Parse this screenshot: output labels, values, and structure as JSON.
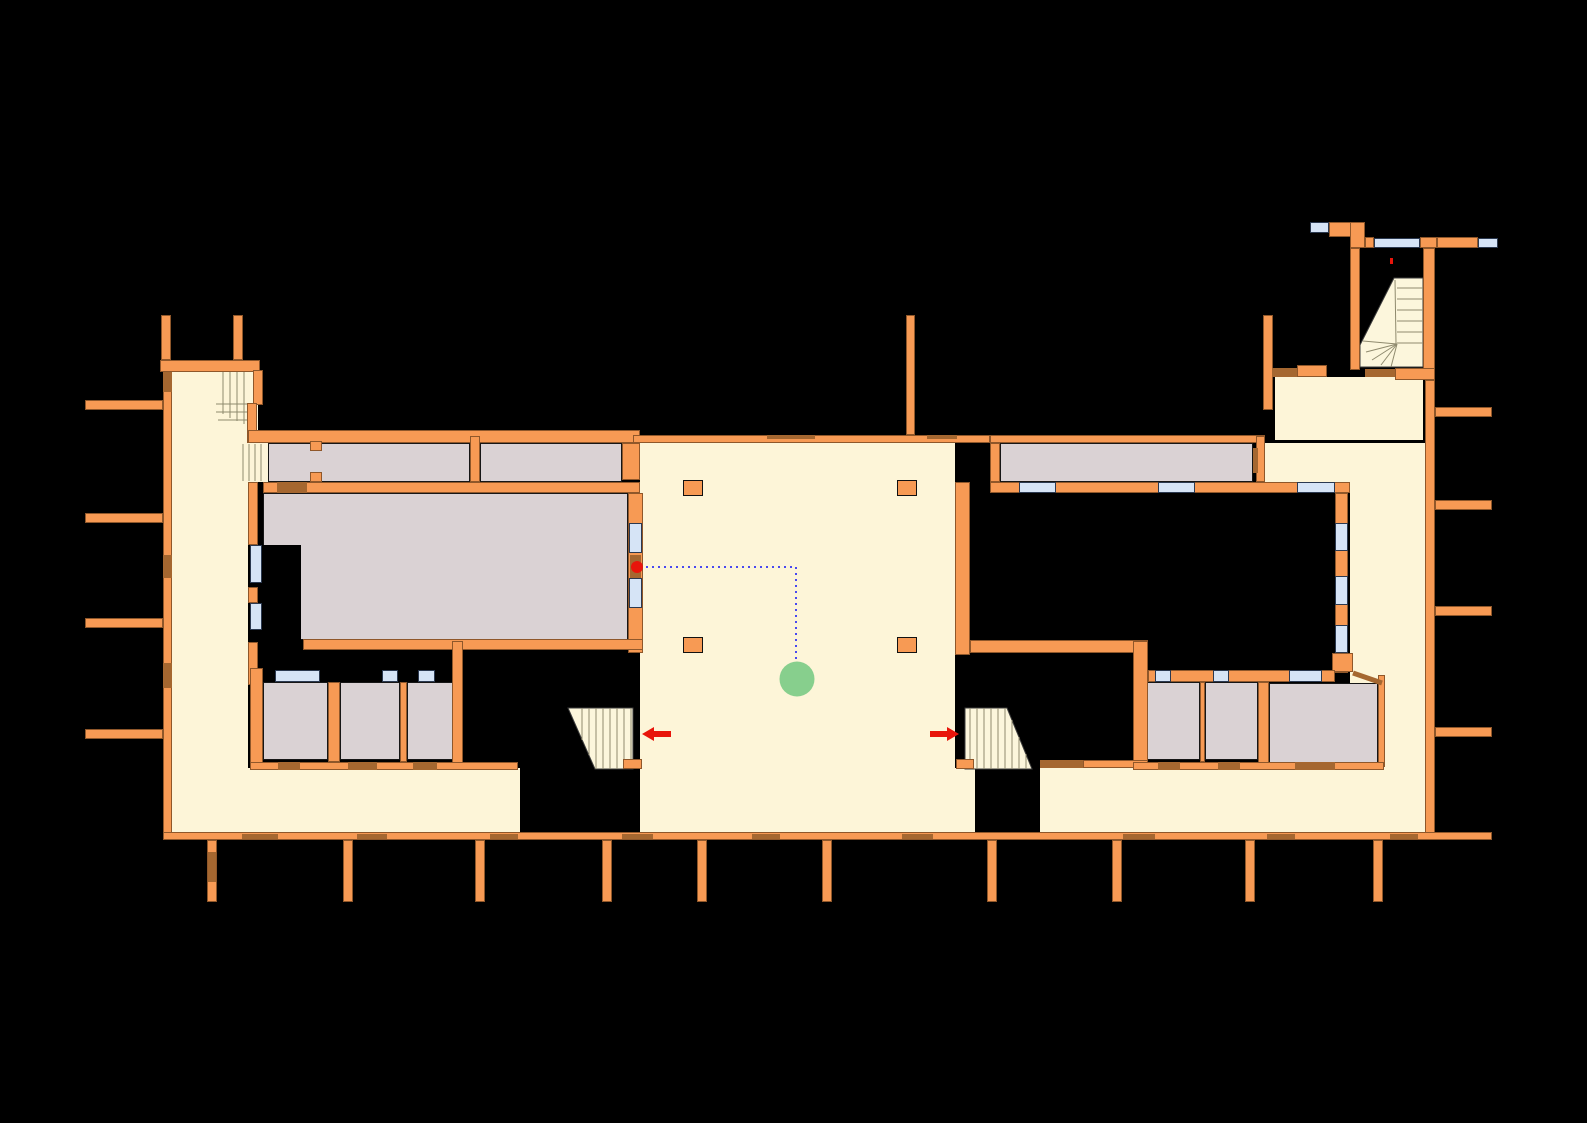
{
  "title": "floor-plan",
  "labels": {
    "hall": "Зала 6",
    "exit_left": "за ет. III",
    "exit_right": "за ет. III"
  },
  "palette": {
    "bg": "#000000",
    "wall": "#F79A54",
    "door": "#A56730",
    "floor": "#FDF5D8",
    "room": "#DAD2D4",
    "window": "#D6E4F6",
    "stair": "#FCF6DC",
    "stair_line": "#8F8A6E",
    "route": "#4949F0",
    "red": "#E8150B",
    "green": "#87CF8D",
    "text": "#111111",
    "wall_border": "rgba(40,20,0,0.5)",
    "window_border": "#2B3950",
    "room_border": "#161616",
    "poly_border": "#3C3C3C"
  },
  "marker": {
    "cx": 797,
    "cy": 679,
    "r": 17.5
  },
  "red_dot": {
    "cx": 637,
    "cy": 567,
    "r": 6
  },
  "red_mark": [
    1390,
    258,
    3,
    6
  ],
  "route_points": "646,567 796,567 796,660",
  "corner_diag": [
    1353,
    673,
    1382,
    683
  ],
  "arrow_left_points": "642,734 654,727 654,731 671,731 671,737 654,737 654,741",
  "arrow_right_points": "959,734 947,727 947,731 930,731 930,737 947,737 947,741",
  "label_pos": {
    "hall": [
      490,
      548
    ],
    "exit_left": [
      672,
      726
    ],
    "exit_right": [
      862,
      726
    ]
  },
  "plan": {
    "floors": [
      [
        170,
        368,
        78,
        465
      ],
      [
        215,
        367,
        43,
        63
      ],
      [
        248,
        442,
        20,
        40
      ],
      [
        640,
        443,
        315,
        325
      ],
      [
        170,
        768,
        350,
        65
      ],
      [
        640,
        768,
        335,
        65
      ],
      [
        1040,
        768,
        385,
        65
      ],
      [
        1275,
        377,
        148,
        63
      ],
      [
        1265,
        443,
        160,
        39
      ],
      [
        1350,
        482,
        75,
        351
      ]
    ],
    "rooms": [
      [
        268,
        443,
        202,
        39
      ],
      [
        480,
        443,
        142,
        39
      ],
      [
        263,
        493,
        365,
        147
      ],
      [
        263,
        682,
        65,
        78
      ],
      [
        340,
        682,
        60,
        78
      ],
      [
        407,
        682,
        46,
        78
      ],
      [
        1000,
        443,
        253,
        39
      ],
      [
        1144,
        682,
        56,
        78
      ],
      [
        1205,
        682,
        53,
        78
      ],
      [
        1269,
        683,
        109,
        81
      ]
    ],
    "voids": [
      [
        263,
        545,
        38,
        95
      ],
      [
        265,
        650,
        187,
        20
      ],
      [
        463,
        650,
        177,
        118
      ],
      [
        520,
        768,
        120,
        64
      ],
      [
        955,
        653,
        178,
        115
      ],
      [
        975,
        768,
        65,
        64
      ]
    ],
    "stair_polys": [
      "568,708 633,708 633,769 595,769",
      "965,708 1007,708 1032,769 965,769",
      "1360,345 1394,278 1423,278 1423,367 1360,367"
    ],
    "stair_lines": [
      [
        223,
        363,
        223,
        414
      ],
      [
        230,
        363,
        230,
        418
      ],
      [
        237,
        363,
        237,
        421
      ],
      [
        244,
        363,
        244,
        424
      ],
      [
        216,
        404,
        247,
        404
      ],
      [
        216,
        412,
        247,
        412
      ],
      [
        218,
        420,
        247,
        420
      ],
      [
        243,
        444,
        243,
        481
      ],
      [
        249,
        444,
        249,
        481
      ],
      [
        255,
        444,
        255,
        481
      ],
      [
        261,
        444,
        261,
        481
      ],
      [
        582,
        708,
        582,
        740
      ],
      [
        589,
        708,
        589,
        755
      ],
      [
        596,
        708,
        596,
        769
      ],
      [
        603,
        708,
        603,
        769
      ],
      [
        610,
        708,
        610,
        769
      ],
      [
        617,
        708,
        617,
        769
      ],
      [
        624,
        708,
        624,
        769
      ],
      [
        631,
        708,
        631,
        769
      ],
      [
        970,
        708,
        970,
        769
      ],
      [
        977,
        708,
        977,
        769
      ],
      [
        984,
        708,
        984,
        769
      ],
      [
        991,
        708,
        991,
        769
      ],
      [
        998,
        708,
        998,
        769
      ],
      [
        1005,
        708,
        1005,
        769
      ],
      [
        1012,
        720,
        1012,
        769
      ],
      [
        1019,
        737,
        1019,
        769
      ],
      [
        1026,
        754,
        1026,
        769
      ],
      [
        1397,
        288,
        1423,
        288
      ],
      [
        1397,
        299,
        1423,
        299
      ],
      [
        1397,
        310,
        1423,
        310
      ],
      [
        1397,
        321,
        1423,
        321
      ],
      [
        1397,
        332,
        1423,
        332
      ],
      [
        1397,
        343,
        1423,
        343
      ],
      [
        1395,
        280,
        1396,
        344
      ],
      [
        1397,
        344,
        1363,
        341
      ],
      [
        1397,
        344,
        1366,
        352
      ],
      [
        1397,
        344,
        1372,
        360
      ],
      [
        1397,
        344,
        1381,
        365
      ],
      [
        1397,
        344,
        1391,
        367
      ]
    ],
    "walls": [
      [
        160,
        360,
        100,
        12
      ],
      [
        161,
        315,
        10,
        45
      ],
      [
        233,
        315,
        10,
        45
      ],
      [
        163,
        372,
        9,
        461
      ],
      [
        85,
        400,
        78,
        10
      ],
      [
        85,
        513,
        78,
        10
      ],
      [
        85,
        618,
        78,
        10
      ],
      [
        85,
        729,
        78,
        10
      ],
      [
        253,
        370,
        10,
        35
      ],
      [
        247,
        403,
        10,
        40
      ],
      [
        248,
        482,
        10,
        63
      ],
      [
        248,
        587,
        10,
        16
      ],
      [
        248,
        642,
        10,
        43
      ],
      [
        250,
        668,
        13,
        102
      ],
      [
        248,
        430,
        392,
        13
      ],
      [
        470,
        436,
        10,
        46
      ],
      [
        310,
        441,
        12,
        10
      ],
      [
        310,
        472,
        12,
        10
      ],
      [
        263,
        482,
        377,
        11
      ],
      [
        628,
        493,
        15,
        160
      ],
      [
        303,
        639,
        340,
        11
      ],
      [
        452,
        641,
        11,
        127
      ],
      [
        328,
        682,
        12,
        80
      ],
      [
        400,
        682,
        7,
        80
      ],
      [
        250,
        762,
        268,
        8
      ],
      [
        623,
        759,
        19,
        10
      ],
      [
        633,
        435,
        357,
        8
      ],
      [
        906,
        315,
        9,
        120
      ],
      [
        622,
        443,
        18,
        37
      ],
      [
        955,
        482,
        15,
        173
      ],
      [
        970,
        640,
        178,
        13
      ],
      [
        1133,
        641,
        15,
        122
      ],
      [
        1083,
        760,
        65,
        8
      ],
      [
        956,
        759,
        18,
        10
      ],
      [
        990,
        435,
        275,
        8
      ],
      [
        990,
        443,
        10,
        39
      ],
      [
        990,
        482,
        360,
        11
      ],
      [
        1256,
        436,
        9,
        46
      ],
      [
        1335,
        493,
        13,
        180
      ],
      [
        1332,
        653,
        21,
        19
      ],
      [
        1148,
        670,
        187,
        12
      ],
      [
        1200,
        682,
        5,
        80
      ],
      [
        1258,
        682,
        11,
        85
      ],
      [
        1378,
        675,
        7,
        92
      ],
      [
        1133,
        762,
        251,
        8
      ],
      [
        1329,
        222,
        36,
        15
      ],
      [
        1350,
        222,
        15,
        26
      ],
      [
        1350,
        248,
        10,
        122
      ],
      [
        1365,
        237,
        9,
        11
      ],
      [
        1420,
        237,
        17,
        11
      ],
      [
        1437,
        237,
        41,
        11
      ],
      [
        1423,
        248,
        12,
        132
      ],
      [
        1395,
        368,
        40,
        12
      ],
      [
        1263,
        315,
        10,
        95
      ],
      [
        1297,
        365,
        30,
        12
      ],
      [
        1425,
        380,
        10,
        453
      ],
      [
        1435,
        407,
        57,
        10
      ],
      [
        1435,
        500,
        57,
        10
      ],
      [
        1435,
        606,
        57,
        10
      ],
      [
        1435,
        727,
        57,
        10
      ],
      [
        163,
        832,
        1329,
        8
      ],
      [
        207,
        840,
        10,
        62
      ],
      [
        343,
        840,
        10,
        62
      ],
      [
        475,
        840,
        10,
        62
      ],
      [
        602,
        840,
        10,
        62
      ],
      [
        697,
        840,
        10,
        62
      ],
      [
        822,
        840,
        10,
        62
      ],
      [
        987,
        840,
        10,
        62
      ],
      [
        1112,
        840,
        10,
        62
      ],
      [
        1245,
        840,
        10,
        62
      ],
      [
        1373,
        840,
        10,
        62
      ]
    ],
    "doors": [
      [
        163,
        372,
        9,
        20
      ],
      [
        163,
        555,
        9,
        23
      ],
      [
        163,
        663,
        9,
        25
      ],
      [
        277,
        482,
        30,
        11
      ],
      [
        630,
        555,
        11,
        25
      ],
      [
        1253,
        448,
        5,
        25
      ],
      [
        278,
        762,
        22,
        8
      ],
      [
        348,
        762,
        29,
        8
      ],
      [
        413,
        762,
        24,
        8
      ],
      [
        1158,
        762,
        22,
        8
      ],
      [
        1218,
        762,
        22,
        8
      ],
      [
        1295,
        762,
        40,
        8
      ],
      [
        1365,
        369,
        30,
        8
      ],
      [
        1272,
        368,
        25,
        9
      ],
      [
        767,
        435,
        48,
        4
      ],
      [
        927,
        435,
        30,
        4
      ],
      [
        1040,
        760,
        43,
        8
      ],
      [
        242,
        834,
        36,
        5
      ],
      [
        357,
        834,
        30,
        5
      ],
      [
        490,
        834,
        28,
        5
      ],
      [
        622,
        834,
        31,
        5
      ],
      [
        752,
        834,
        28,
        5
      ],
      [
        902,
        834,
        31,
        5
      ],
      [
        1123,
        834,
        32,
        5
      ],
      [
        1267,
        834,
        28,
        5
      ],
      [
        1390,
        834,
        28,
        5
      ],
      [
        208,
        852,
        8,
        30
      ]
    ],
    "windows": [
      [
        250,
        545,
        12,
        38
      ],
      [
        250,
        603,
        12,
        27
      ],
      [
        275,
        670,
        45,
        12
      ],
      [
        382,
        670,
        16,
        12
      ],
      [
        418,
        670,
        17,
        12
      ],
      [
        629,
        523,
        13,
        30
      ],
      [
        629,
        578,
        13,
        30
      ],
      [
        1019,
        482,
        37,
        11
      ],
      [
        1158,
        482,
        37,
        11
      ],
      [
        1297,
        482,
        38,
        11
      ],
      [
        1335,
        523,
        13,
        28
      ],
      [
        1335,
        576,
        13,
        29
      ],
      [
        1335,
        625,
        13,
        28
      ],
      [
        1155,
        670,
        16,
        12
      ],
      [
        1213,
        670,
        16,
        12
      ],
      [
        1289,
        670,
        33,
        12
      ],
      [
        1310,
        222,
        19,
        11
      ],
      [
        1374,
        238,
        46,
        10
      ],
      [
        1478,
        238,
        20,
        10
      ]
    ],
    "pillars": [
      [
        683,
        480,
        20,
        16
      ],
      [
        897,
        480,
        20,
        16
      ],
      [
        683,
        637,
        20,
        16
      ],
      [
        897,
        637,
        20,
        16
      ]
    ]
  }
}
